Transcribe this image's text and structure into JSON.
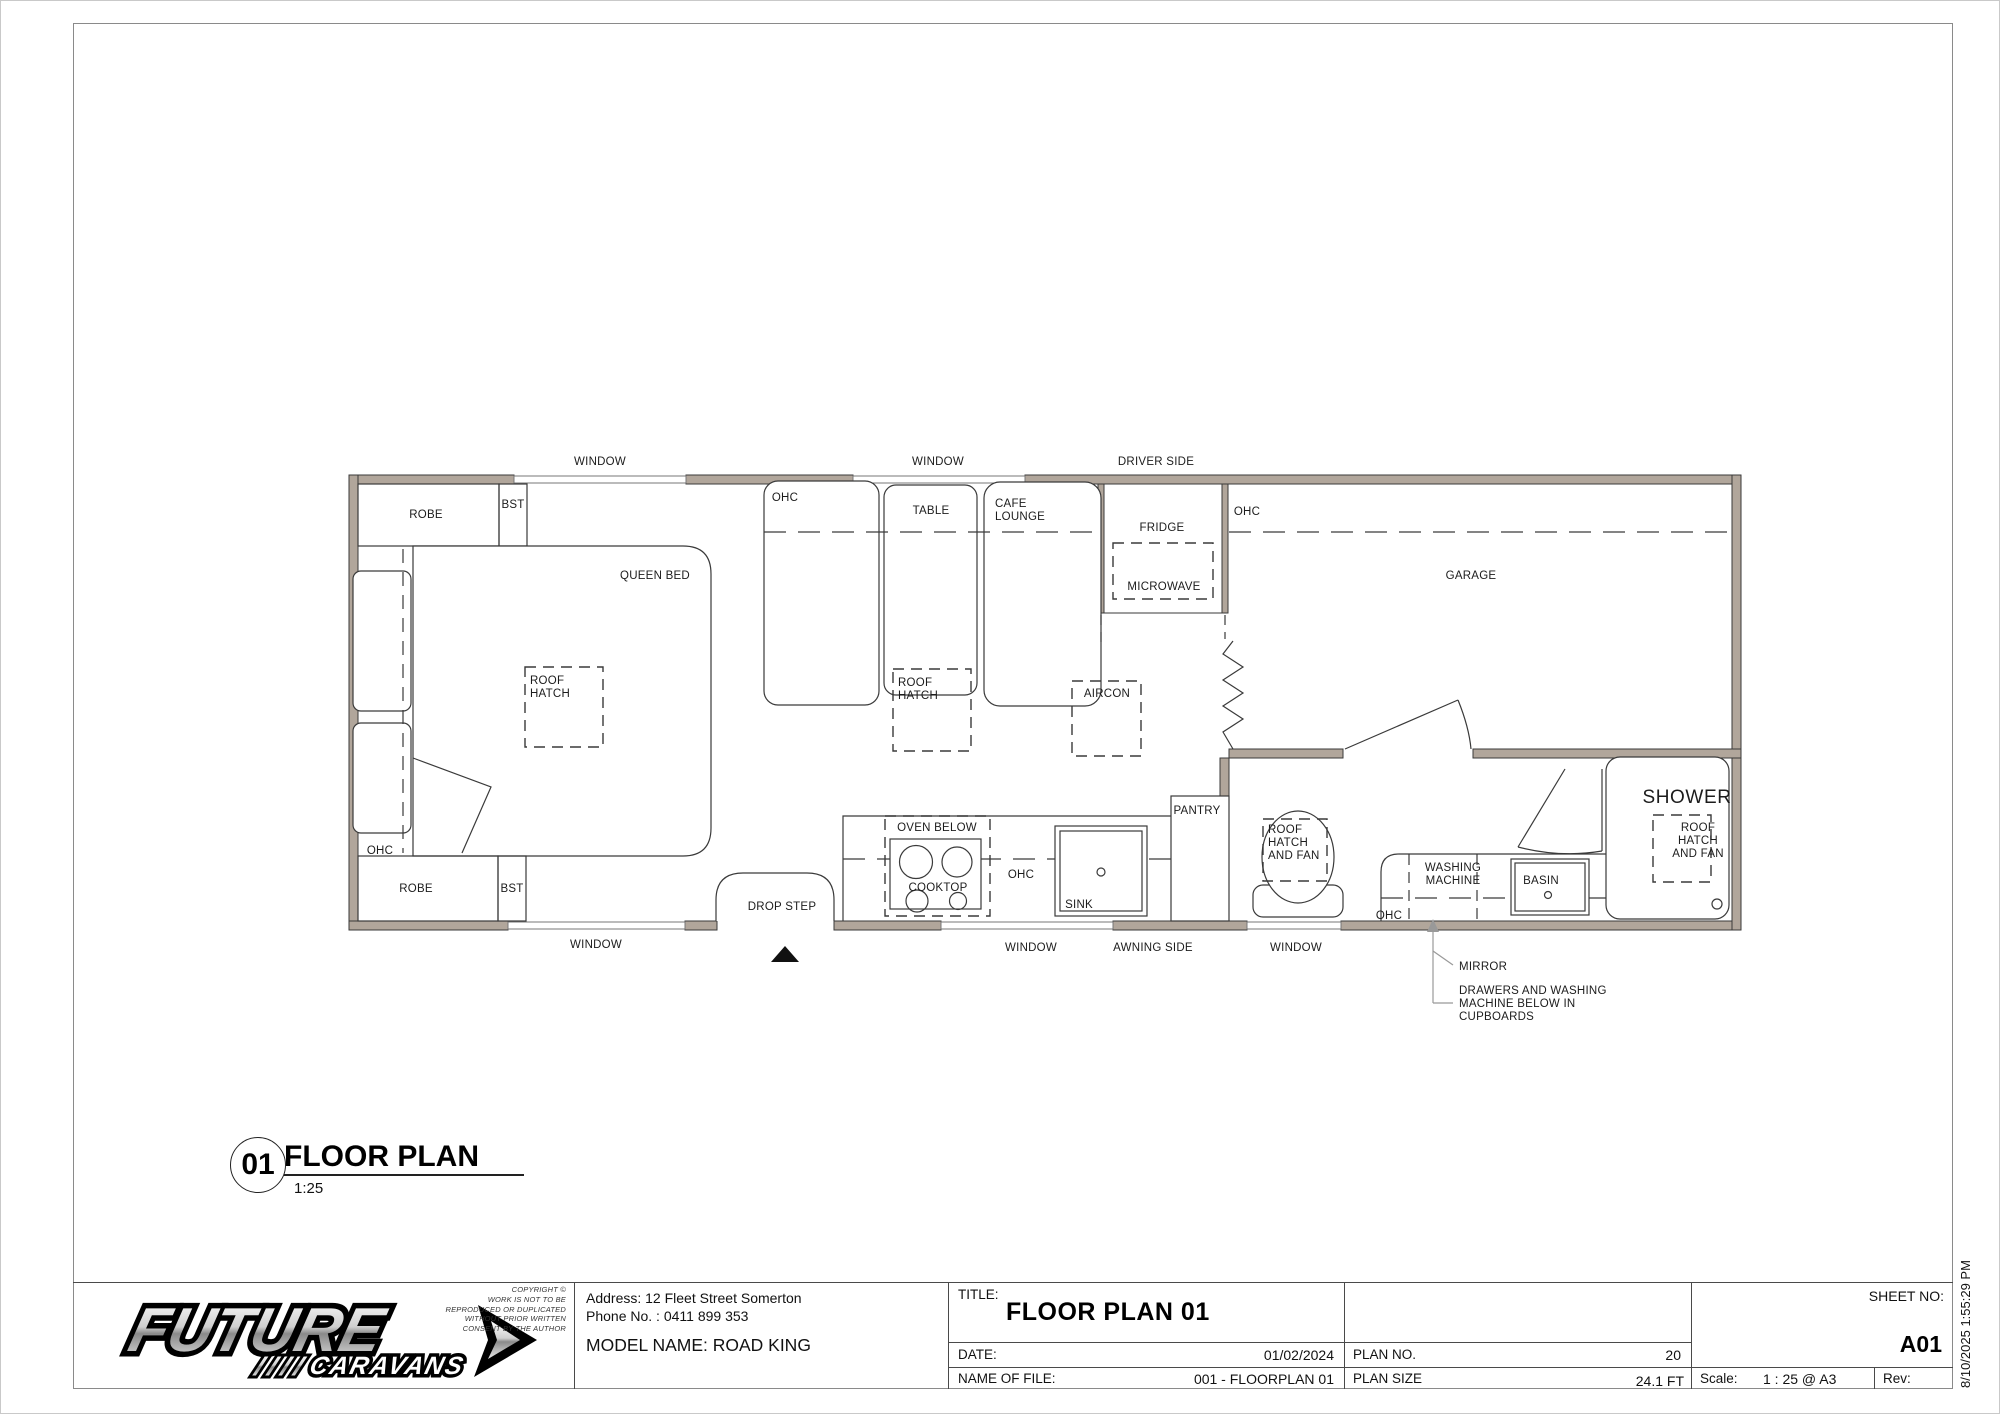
{
  "colors": {
    "wall": "#b1a69b",
    "line": "#3a3a3a",
    "dash": "#4a4a4a",
    "leader": "#999999",
    "window": "#ffffff"
  },
  "plan": {
    "labels": {
      "window_top_1": "WINDOW",
      "window_top_2": "WINDOW",
      "driver_side": "DRIVER SIDE",
      "robe_top": "ROBE",
      "bst_top": "BST",
      "queen_bed": "QUEEN BED",
      "ohc_bed": "OHC",
      "roof_hatch_bed": "ROOF HATCH",
      "table": "TABLE",
      "cafe_lounge": "CAFE LOUNGE",
      "fridge": "FRIDGE",
      "microwave": "MICROWAVE",
      "ohc_garage": "OHC",
      "garage": "GARAGE",
      "roof_hatch_lounge": "ROOF HATCH",
      "aircon": "AIRCON",
      "ohc_bedroom_left": "OHC",
      "robe_bottom": "ROBE",
      "bst_bottom": "BST",
      "window_bottom_1": "WINDOW",
      "drop_step": "DROP STEP",
      "oven_below": "OVEN BELOW",
      "cooktop": "COOKTOP",
      "ohc_kitchen": "OHC",
      "sink": "SINK",
      "pantry": "PANTRY",
      "window_bottom_2": "WINDOW",
      "awning_side": "AWNING SIDE",
      "roof_hatch_fan_toilet": "ROOF HATCH AND FAN",
      "washing_machine": "WASHING MACHINE",
      "ohc_bathroom": "OHC",
      "basin": "BASIN",
      "window_bottom_3": "WINDOW",
      "shower": "SHOWER",
      "roof_hatch_fan_shower": "ROOF HATCH AND FAN",
      "mirror": "MIRROR",
      "drawers_note": "DRAWERS AND WASHING MACHINE BELOW IN CUPBOARDS"
    }
  },
  "heading": {
    "number": "01",
    "title": "FLOOR PLAN",
    "scale": "1:25"
  },
  "titleblock": {
    "brand": "FUTURE",
    "brand_sub": "CARAVANS",
    "copyright": [
      "COPYRIGHT ©",
      "WORK IS NOT TO BE",
      "REPRODUCED OR DUPLICATED",
      "WITHOUT PRIOR WRITTEN",
      "CONSENT BY THE AUTHOR"
    ],
    "address_line": "Address: 12 Fleet Street Somerton",
    "phone_line": "Phone No. : 0411 899 353",
    "model_line": "MODEL NAME: ROAD KING",
    "title_label": "TITLE:",
    "title_value": "FLOOR PLAN 01",
    "date_label": "DATE:",
    "date_value": "01/02/2024",
    "file_label": "NAME OF FILE:",
    "file_value": "001 - FLOORPLAN 01",
    "plan_no_label": "PLAN NO.",
    "plan_no_value": "20",
    "plan_size_label": "PLAN SIZE",
    "plan_size_value": "24.1 FT",
    "scale_label": "Scale:",
    "scale_value": "1 : 25 @ A3",
    "rev_label": "Rev:",
    "sheet_no_label": "SHEET NO:",
    "sheet_no_value": "A01",
    "timestamp": "8/10/2025 1:55:29 PM"
  }
}
